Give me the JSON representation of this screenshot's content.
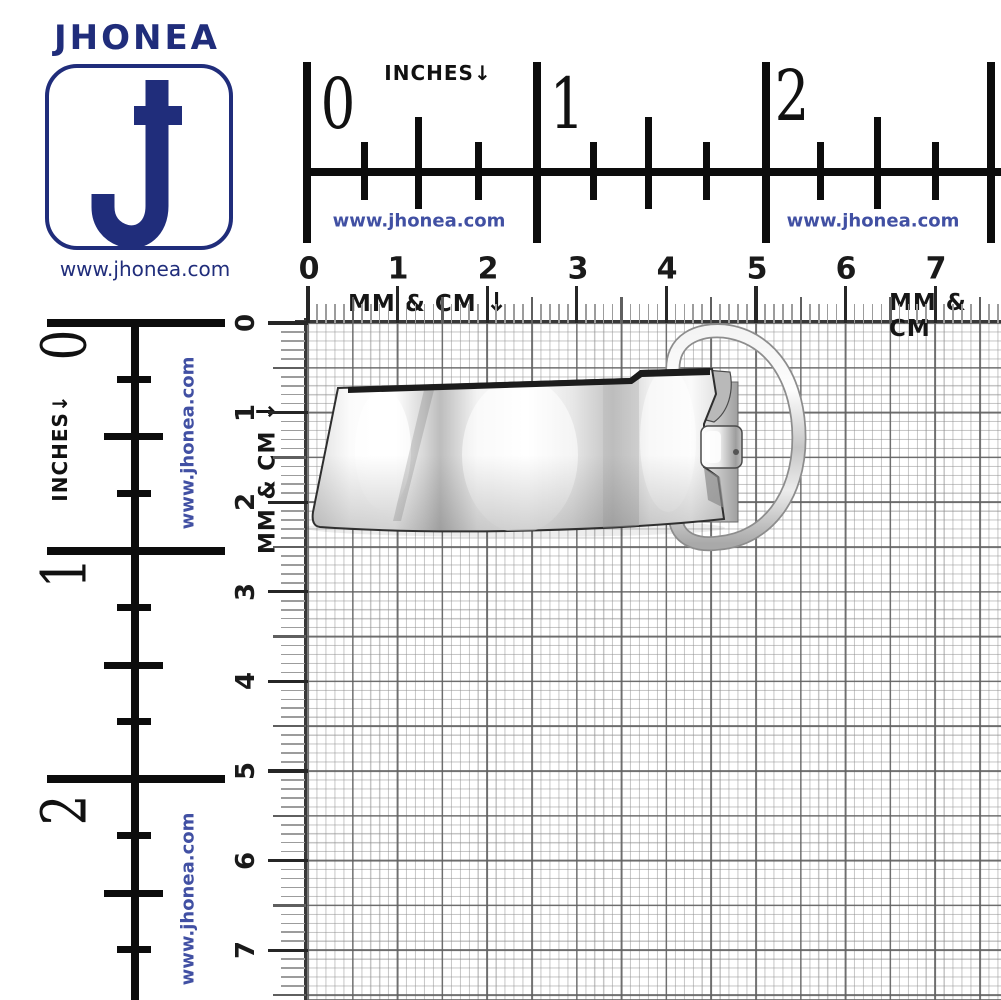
{
  "logo": {
    "brand": "JHONEA",
    "website": "www.jhonea.com"
  },
  "watermark": "www.jhonea.com",
  "rulers": {
    "top_inches": {
      "title": "INCHES",
      "arrow": "↓",
      "numbers": [
        "0",
        "1",
        "2"
      ]
    },
    "top_cm": {
      "title": "MM & CM",
      "arrow": "↓",
      "title_right": "MM & CM",
      "numbers": [
        "0",
        "1",
        "2",
        "3",
        "4",
        "5",
        "6",
        "7"
      ]
    },
    "left_inches": {
      "title": "INCHES",
      "arrow": "↓",
      "numbers": [
        "0",
        "1",
        "2"
      ]
    },
    "left_cm": {
      "title": "MM & CM",
      "arrow": "↓",
      "numbers": [
        "0",
        "1",
        "2",
        "3",
        "4",
        "5",
        "6",
        "7"
      ]
    }
  },
  "product": {
    "name": "polished-silver-ribbon-clamp-clip-with-d-ring"
  },
  "colors": {
    "brand_navy": "#202d7b",
    "link_blue": "#4150a3",
    "ruler_ink": "#0c0c0c",
    "grid_major": "#5f5f5f",
    "grid_minor": "#8c8c8c"
  }
}
